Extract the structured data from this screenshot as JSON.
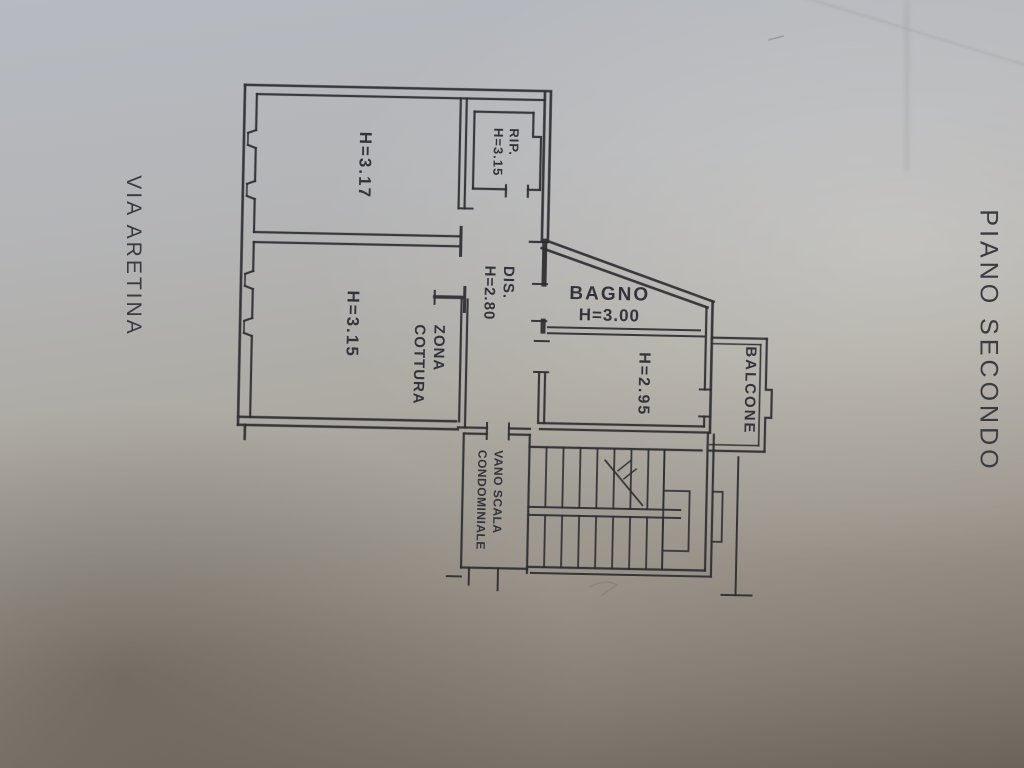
{
  "labels": {
    "street": "VIA ARETINA",
    "floor": "PIANO SECONDO"
  },
  "rooms": {
    "room_top_left": {
      "height": "H=3.17"
    },
    "storage": {
      "name": "RIP.",
      "height": "H=3.15"
    },
    "hall": {
      "name": "DIS.",
      "height": "H=2.80"
    },
    "room_bottom_left": {
      "height": "H=3.15"
    },
    "kitchen_area": {
      "line1": "ZONA",
      "line2": "COTTURA"
    },
    "bathroom": {
      "name": "BAGNO",
      "height": "H=3.00"
    },
    "room_right": {
      "height": "H=2.95"
    },
    "balcony": {
      "name": "BALCONE"
    },
    "stairwell": {
      "line1": "VANO SCALA",
      "line2": "CONDOMINIALE"
    }
  },
  "colors": {
    "ink": "#2c2c32",
    "text": "#33333b",
    "paper_top": "#b6bac1",
    "paper_mid": "#adaaa2",
    "paper_bottom": "#6a645b"
  }
}
